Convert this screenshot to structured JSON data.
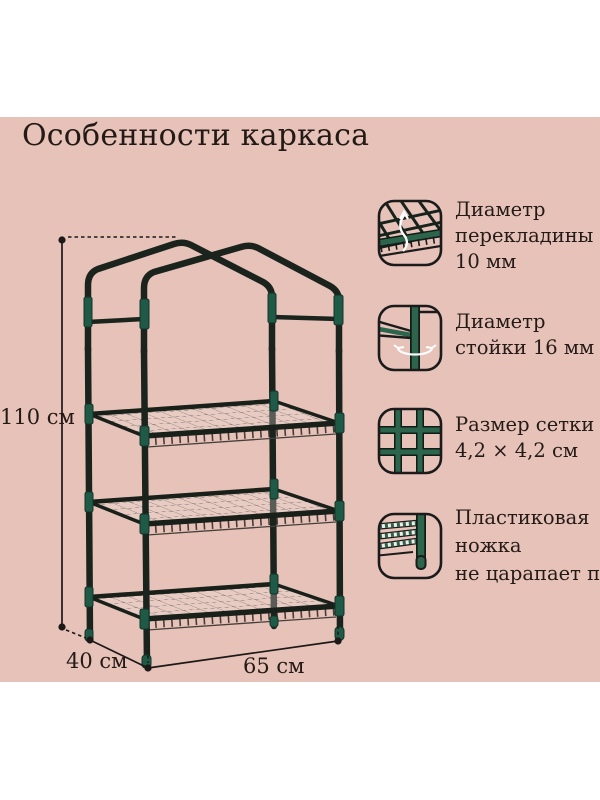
{
  "title": "Особенности каркаса",
  "dimensions": {
    "height_label": "110 см",
    "depth_label": "40 см",
    "width_label": "65 см"
  },
  "features": [
    {
      "icon": "crossbar-mesh-icon",
      "lines": [
        "Диаметр",
        "перекладины",
        "10 мм"
      ]
    },
    {
      "icon": "post-diameter-icon",
      "lines": [
        "Диаметр",
        "стойки 16 мм"
      ]
    },
    {
      "icon": "mesh-size-icon",
      "lines": [
        "Размер сетки",
        "4,2 × 4,2 см"
      ]
    },
    {
      "icon": "plastic-foot-icon",
      "lines": [
        "Пластиковая",
        "ножка",
        "не царапает пол"
      ]
    }
  ],
  "colors": {
    "background_pink": "#e6c2b9",
    "frame_dark": "#1b231d",
    "connector_green": "#1f5a46",
    "icon_green": "#2c644c",
    "text_dark": "#241a15"
  }
}
